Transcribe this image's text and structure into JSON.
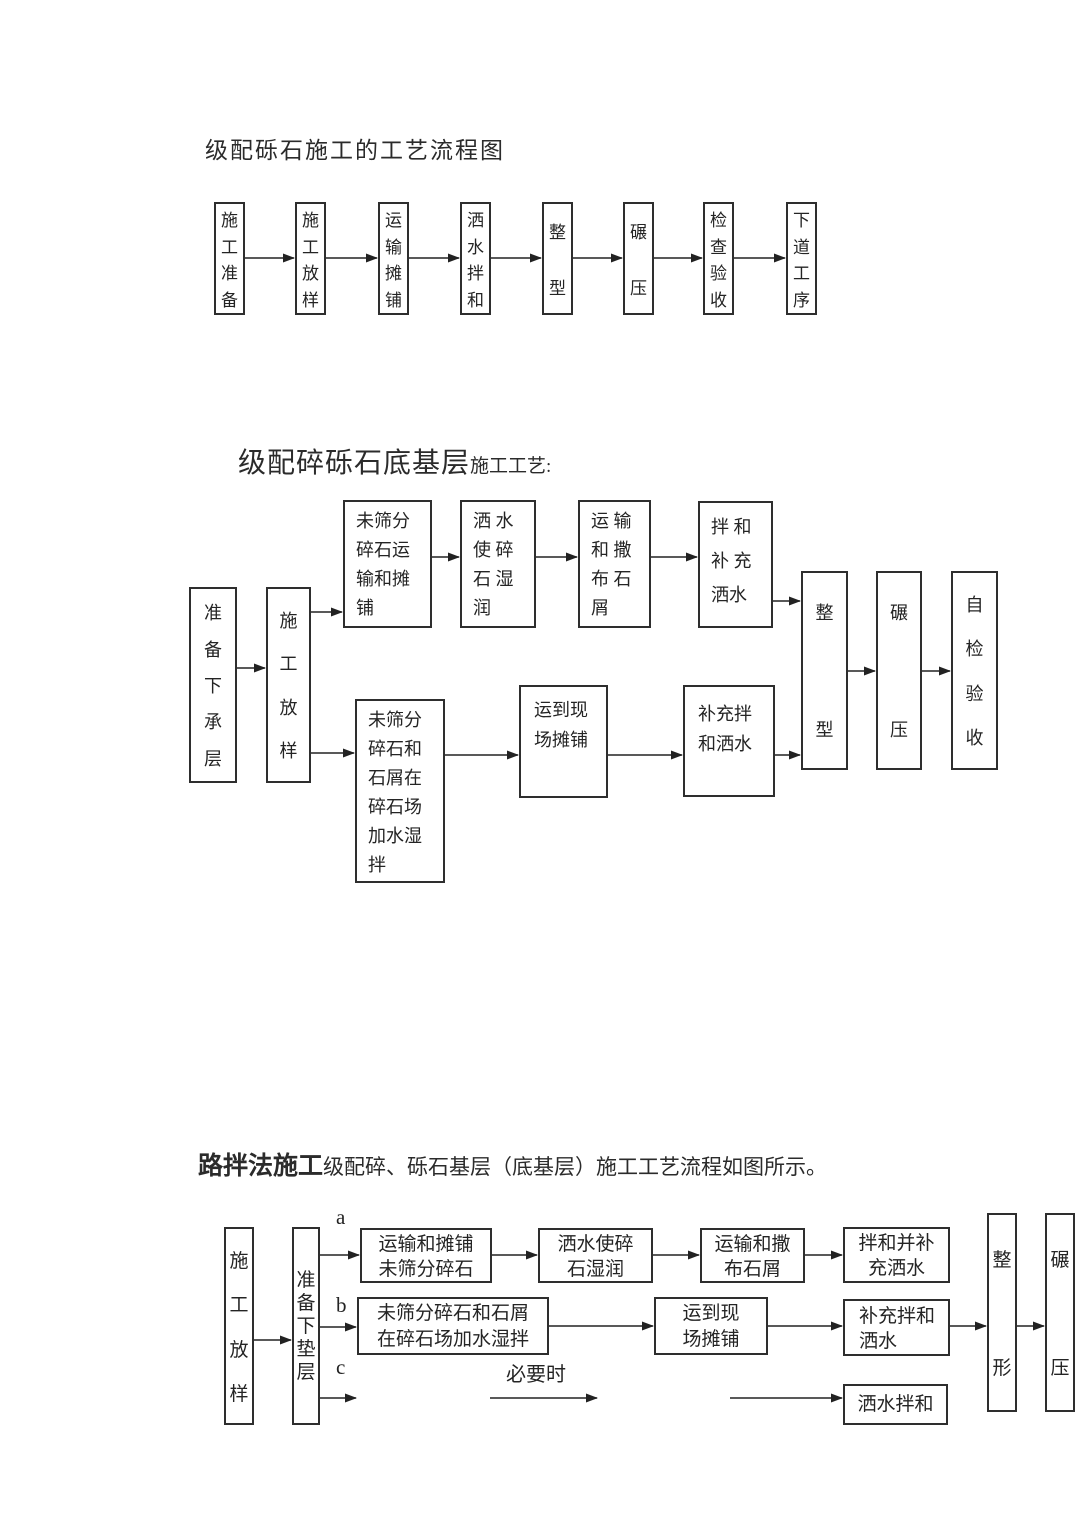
{
  "page": {
    "width": 1080,
    "height": 1527,
    "background": "#ffffff",
    "line_color": "#222222",
    "border_color": "#2e2e2e"
  },
  "titles": {
    "t1": "级配砾石施工的工艺流程图",
    "t2_main": "级配碎砾石底基层",
    "t2_sub": "施工工艺:",
    "t3_main": "路拌法施工",
    "t3_sub": "级配碎、砾石基层（底基层）施工工艺流程如图所示。"
  },
  "flowcharts": [
    {
      "id": "fc1",
      "nodes": [
        {
          "x": 214,
          "y": 202,
          "w": 31,
          "h": 113,
          "mode": "v",
          "text": "施工准备",
          "fs": 17
        },
        {
          "x": 295,
          "y": 202,
          "w": 31,
          "h": 113,
          "mode": "v",
          "text": "施工放样",
          "fs": 17
        },
        {
          "x": 378,
          "y": 202,
          "w": 31,
          "h": 113,
          "mode": "v",
          "text": "运输摊铺",
          "fs": 17
        },
        {
          "x": 460,
          "y": 202,
          "w": 31,
          "h": 113,
          "mode": "v",
          "text": "洒水拌和",
          "fs": 17
        },
        {
          "x": 542,
          "y": 202,
          "w": 31,
          "h": 113,
          "mode": "v",
          "text": "整型",
          "fs": 17,
          "pack": "spread",
          "pad": 14
        },
        {
          "x": 623,
          "y": 202,
          "w": 31,
          "h": 113,
          "mode": "v",
          "text": "碾压",
          "fs": 17,
          "pack": "spread",
          "pad": 14
        },
        {
          "x": 703,
          "y": 202,
          "w": 31,
          "h": 113,
          "mode": "v",
          "text": "检查验收",
          "fs": 17
        },
        {
          "x": 786,
          "y": 202,
          "w": 31,
          "h": 113,
          "mode": "v",
          "text": "下道工序",
          "fs": 17
        }
      ],
      "arrows": [
        {
          "x1": 245,
          "y1": 258,
          "x2": 294,
          "y2": 258
        },
        {
          "x1": 326,
          "y1": 258,
          "x2": 377,
          "y2": 258
        },
        {
          "x1": 409,
          "y1": 258,
          "x2": 459,
          "y2": 258
        },
        {
          "x1": 491,
          "y1": 258,
          "x2": 541,
          "y2": 258
        },
        {
          "x1": 573,
          "y1": 258,
          "x2": 622,
          "y2": 258
        },
        {
          "x1": 654,
          "y1": 258,
          "x2": 702,
          "y2": 258
        },
        {
          "x1": 734,
          "y1": 258,
          "x2": 785,
          "y2": 258
        }
      ],
      "labels": []
    },
    {
      "id": "fc2",
      "nodes": [
        {
          "x": 189,
          "y": 587,
          "w": 48,
          "h": 196,
          "mode": "v",
          "text": "准备下承层",
          "fs": 18
        },
        {
          "x": 266,
          "y": 587,
          "w": 45,
          "h": 196,
          "mode": "v",
          "text": "施工放样",
          "fs": 18
        },
        {
          "x": 343,
          "y": 500,
          "w": 89,
          "h": 128,
          "mode": "l",
          "lines": [
            "未筛分",
            "碎石运",
            "输和摊",
            "铺"
          ],
          "fs": 18,
          "lh": 29,
          "align": "left",
          "pt": 5,
          "pl": 11
        },
        {
          "x": 460,
          "y": 500,
          "w": 76,
          "h": 128,
          "mode": "l",
          "lines": [
            "洒 水",
            "使 碎",
            "石 湿",
            "润"
          ],
          "fs": 18,
          "lh": 29,
          "align": "left",
          "pt": 5,
          "pl": 11
        },
        {
          "x": 578,
          "y": 500,
          "w": 73,
          "h": 128,
          "mode": "l",
          "lines": [
            "运 输",
            "和 撒",
            "布 石",
            "屑"
          ],
          "fs": 18,
          "lh": 29,
          "align": "left",
          "pt": 5,
          "pl": 11
        },
        {
          "x": 698,
          "y": 501,
          "w": 75,
          "h": 127,
          "mode": "l",
          "lines": [
            "拌 和",
            "补 充",
            "洒水"
          ],
          "fs": 18,
          "lh": 34,
          "align": "left",
          "pt": 7,
          "pl": 11
        },
        {
          "x": 355,
          "y": 699,
          "w": 90,
          "h": 184,
          "mode": "l",
          "lines": [
            "未筛分",
            "碎石和",
            "石屑在",
            "碎石场",
            "加水湿",
            "拌"
          ],
          "fs": 18,
          "lh": 29,
          "align": "left",
          "pt": 5,
          "pl": 11
        },
        {
          "x": 519,
          "y": 685,
          "w": 89,
          "h": 113,
          "mode": "l",
          "lines": [
            "运到现",
            "场摊铺"
          ],
          "fs": 18,
          "lh": 30,
          "align": "left",
          "pt": 8,
          "pl": 13
        },
        {
          "x": 683,
          "y": 685,
          "w": 92,
          "h": 112,
          "mode": "l",
          "lines": [
            "补充拌",
            "和洒水"
          ],
          "fs": 18,
          "lh": 30,
          "align": "left",
          "pt": 12,
          "pl": 13
        },
        {
          "x": 801,
          "y": 571,
          "w": 47,
          "h": 199,
          "mode": "v",
          "text": "整型",
          "fs": 18,
          "pack": "spread",
          "pad": 26
        },
        {
          "x": 876,
          "y": 571,
          "w": 46,
          "h": 199,
          "mode": "v",
          "text": "碾压",
          "fs": 18,
          "pack": "spread",
          "pad": 26
        },
        {
          "x": 951,
          "y": 571,
          "w": 47,
          "h": 199,
          "mode": "v",
          "text": "自检验收",
          "fs": 18
        }
      ],
      "arrows": [
        {
          "x1": 237,
          "y1": 668,
          "x2": 265,
          "y2": 668
        },
        {
          "x1": 311,
          "y1": 612,
          "x2": 342,
          "y2": 612
        },
        {
          "x1": 311,
          "y1": 753,
          "x2": 354,
          "y2": 753
        },
        {
          "x1": 432,
          "y1": 557,
          "x2": 459,
          "y2": 557
        },
        {
          "x1": 536,
          "y1": 557,
          "x2": 577,
          "y2": 557
        },
        {
          "x1": 651,
          "y1": 557,
          "x2": 697,
          "y2": 557
        },
        {
          "x1": 773,
          "y1": 601,
          "x2": 800,
          "y2": 601
        },
        {
          "x1": 445,
          "y1": 755,
          "x2": 518,
          "y2": 755
        },
        {
          "x1": 608,
          "y1": 755,
          "x2": 682,
          "y2": 755
        },
        {
          "x1": 775,
          "y1": 755,
          "x2": 800,
          "y2": 755
        },
        {
          "x1": 848,
          "y1": 671,
          "x2": 875,
          "y2": 671
        },
        {
          "x1": 922,
          "y1": 671,
          "x2": 950,
          "y2": 671
        }
      ],
      "labels": []
    },
    {
      "id": "fc3",
      "nodes": [
        {
          "x": 224,
          "y": 1227,
          "w": 30,
          "h": 198,
          "mode": "v",
          "text": "施工放样",
          "fs": 19
        },
        {
          "x": 292,
          "y": 1227,
          "w": 28,
          "h": 198,
          "mode": "v",
          "text": "准备下垫层",
          "fs": 19,
          "pack": "center",
          "lh": 23
        },
        {
          "x": 360,
          "y": 1228,
          "w": 132,
          "h": 55,
          "mode": "l",
          "lines": [
            "运输和摊铺",
            "未筛分碎石"
          ],
          "fs": 19,
          "lh": 25,
          "align": "center",
          "pt": 2
        },
        {
          "x": 538,
          "y": 1228,
          "w": 115,
          "h": 55,
          "mode": "l",
          "lines": [
            "洒水使碎",
            "石湿润"
          ],
          "fs": 19,
          "lh": 25,
          "align": "center",
          "pt": 2
        },
        {
          "x": 700,
          "y": 1228,
          "w": 105,
          "h": 55,
          "mode": "l",
          "lines": [
            "运输和撒",
            "布石屑"
          ],
          "fs": 19,
          "lh": 25,
          "align": "center",
          "pt": 2
        },
        {
          "x": 843,
          "y": 1227,
          "w": 107,
          "h": 56,
          "mode": "l",
          "lines": [
            "拌和并补",
            "充洒水"
          ],
          "fs": 19,
          "lh": 25,
          "align": "center",
          "pt": 2
        },
        {
          "x": 357,
          "y": 1297,
          "w": 192,
          "h": 58,
          "mode": "l",
          "lines": [
            "未筛分碎石和石屑",
            "在碎石场加水湿拌"
          ],
          "fs": 19,
          "lh": 26,
          "align": "center",
          "pt": 2
        },
        {
          "x": 654,
          "y": 1297,
          "w": 114,
          "h": 58,
          "mode": "l",
          "lines": [
            "运到现",
            "场摊铺"
          ],
          "fs": 19,
          "lh": 26,
          "align": "center",
          "pt": 2
        },
        {
          "x": 843,
          "y": 1299,
          "w": 107,
          "h": 57,
          "mode": "l",
          "lines": [
            "补充拌和",
            "洒水"
          ],
          "fs": 19,
          "lh": 25,
          "align": "left",
          "pt": 3,
          "pl": 14
        },
        {
          "x": 843,
          "y": 1384,
          "w": 105,
          "h": 41,
          "mode": "l",
          "lines": [
            "洒水拌和"
          ],
          "fs": 19,
          "lh": 25,
          "align": "center",
          "vc": 1
        },
        {
          "x": 987,
          "y": 1213,
          "w": 30,
          "h": 199,
          "mode": "v",
          "text": "整形",
          "fs": 19,
          "pack": "spread",
          "pad": 30
        },
        {
          "x": 1045,
          "y": 1213,
          "w": 30,
          "h": 199,
          "mode": "v",
          "text": "碾压",
          "fs": 19,
          "pack": "spread",
          "pad": 30
        }
      ],
      "arrows": [
        {
          "x1": 254,
          "y1": 1340,
          "x2": 291,
          "y2": 1340
        },
        {
          "x1": 320,
          "y1": 1255,
          "x2": 359,
          "y2": 1255
        },
        {
          "x1": 320,
          "y1": 1327,
          "x2": 356,
          "y2": 1327
        },
        {
          "x1": 320,
          "y1": 1398,
          "x2": 356,
          "y2": 1398
        },
        {
          "x1": 492,
          "y1": 1255,
          "x2": 537,
          "y2": 1255
        },
        {
          "x1": 653,
          "y1": 1255,
          "x2": 699,
          "y2": 1255
        },
        {
          "x1": 805,
          "y1": 1255,
          "x2": 842,
          "y2": 1255
        },
        {
          "x1": 549,
          "y1": 1326,
          "x2": 653,
          "y2": 1326
        },
        {
          "x1": 768,
          "y1": 1326,
          "x2": 842,
          "y2": 1326
        },
        {
          "x1": 950,
          "y1": 1326,
          "x2": 986,
          "y2": 1326
        },
        {
          "x1": 1017,
          "y1": 1326,
          "x2": 1044,
          "y2": 1326
        },
        {
          "x1": 490,
          "y1": 1398,
          "x2": 597,
          "y2": 1398
        },
        {
          "x1": 730,
          "y1": 1398,
          "x2": 842,
          "y2": 1398
        }
      ],
      "labels": [
        {
          "text": "a",
          "x": 336,
          "y": 1205,
          "fs": 21
        },
        {
          "text": "b",
          "x": 336,
          "y": 1293,
          "fs": 21
        },
        {
          "text": "c",
          "x": 336,
          "y": 1355,
          "fs": 21
        },
        {
          "text": "必要时",
          "x": 506,
          "y": 1358,
          "fs": 20
        }
      ]
    }
  ]
}
